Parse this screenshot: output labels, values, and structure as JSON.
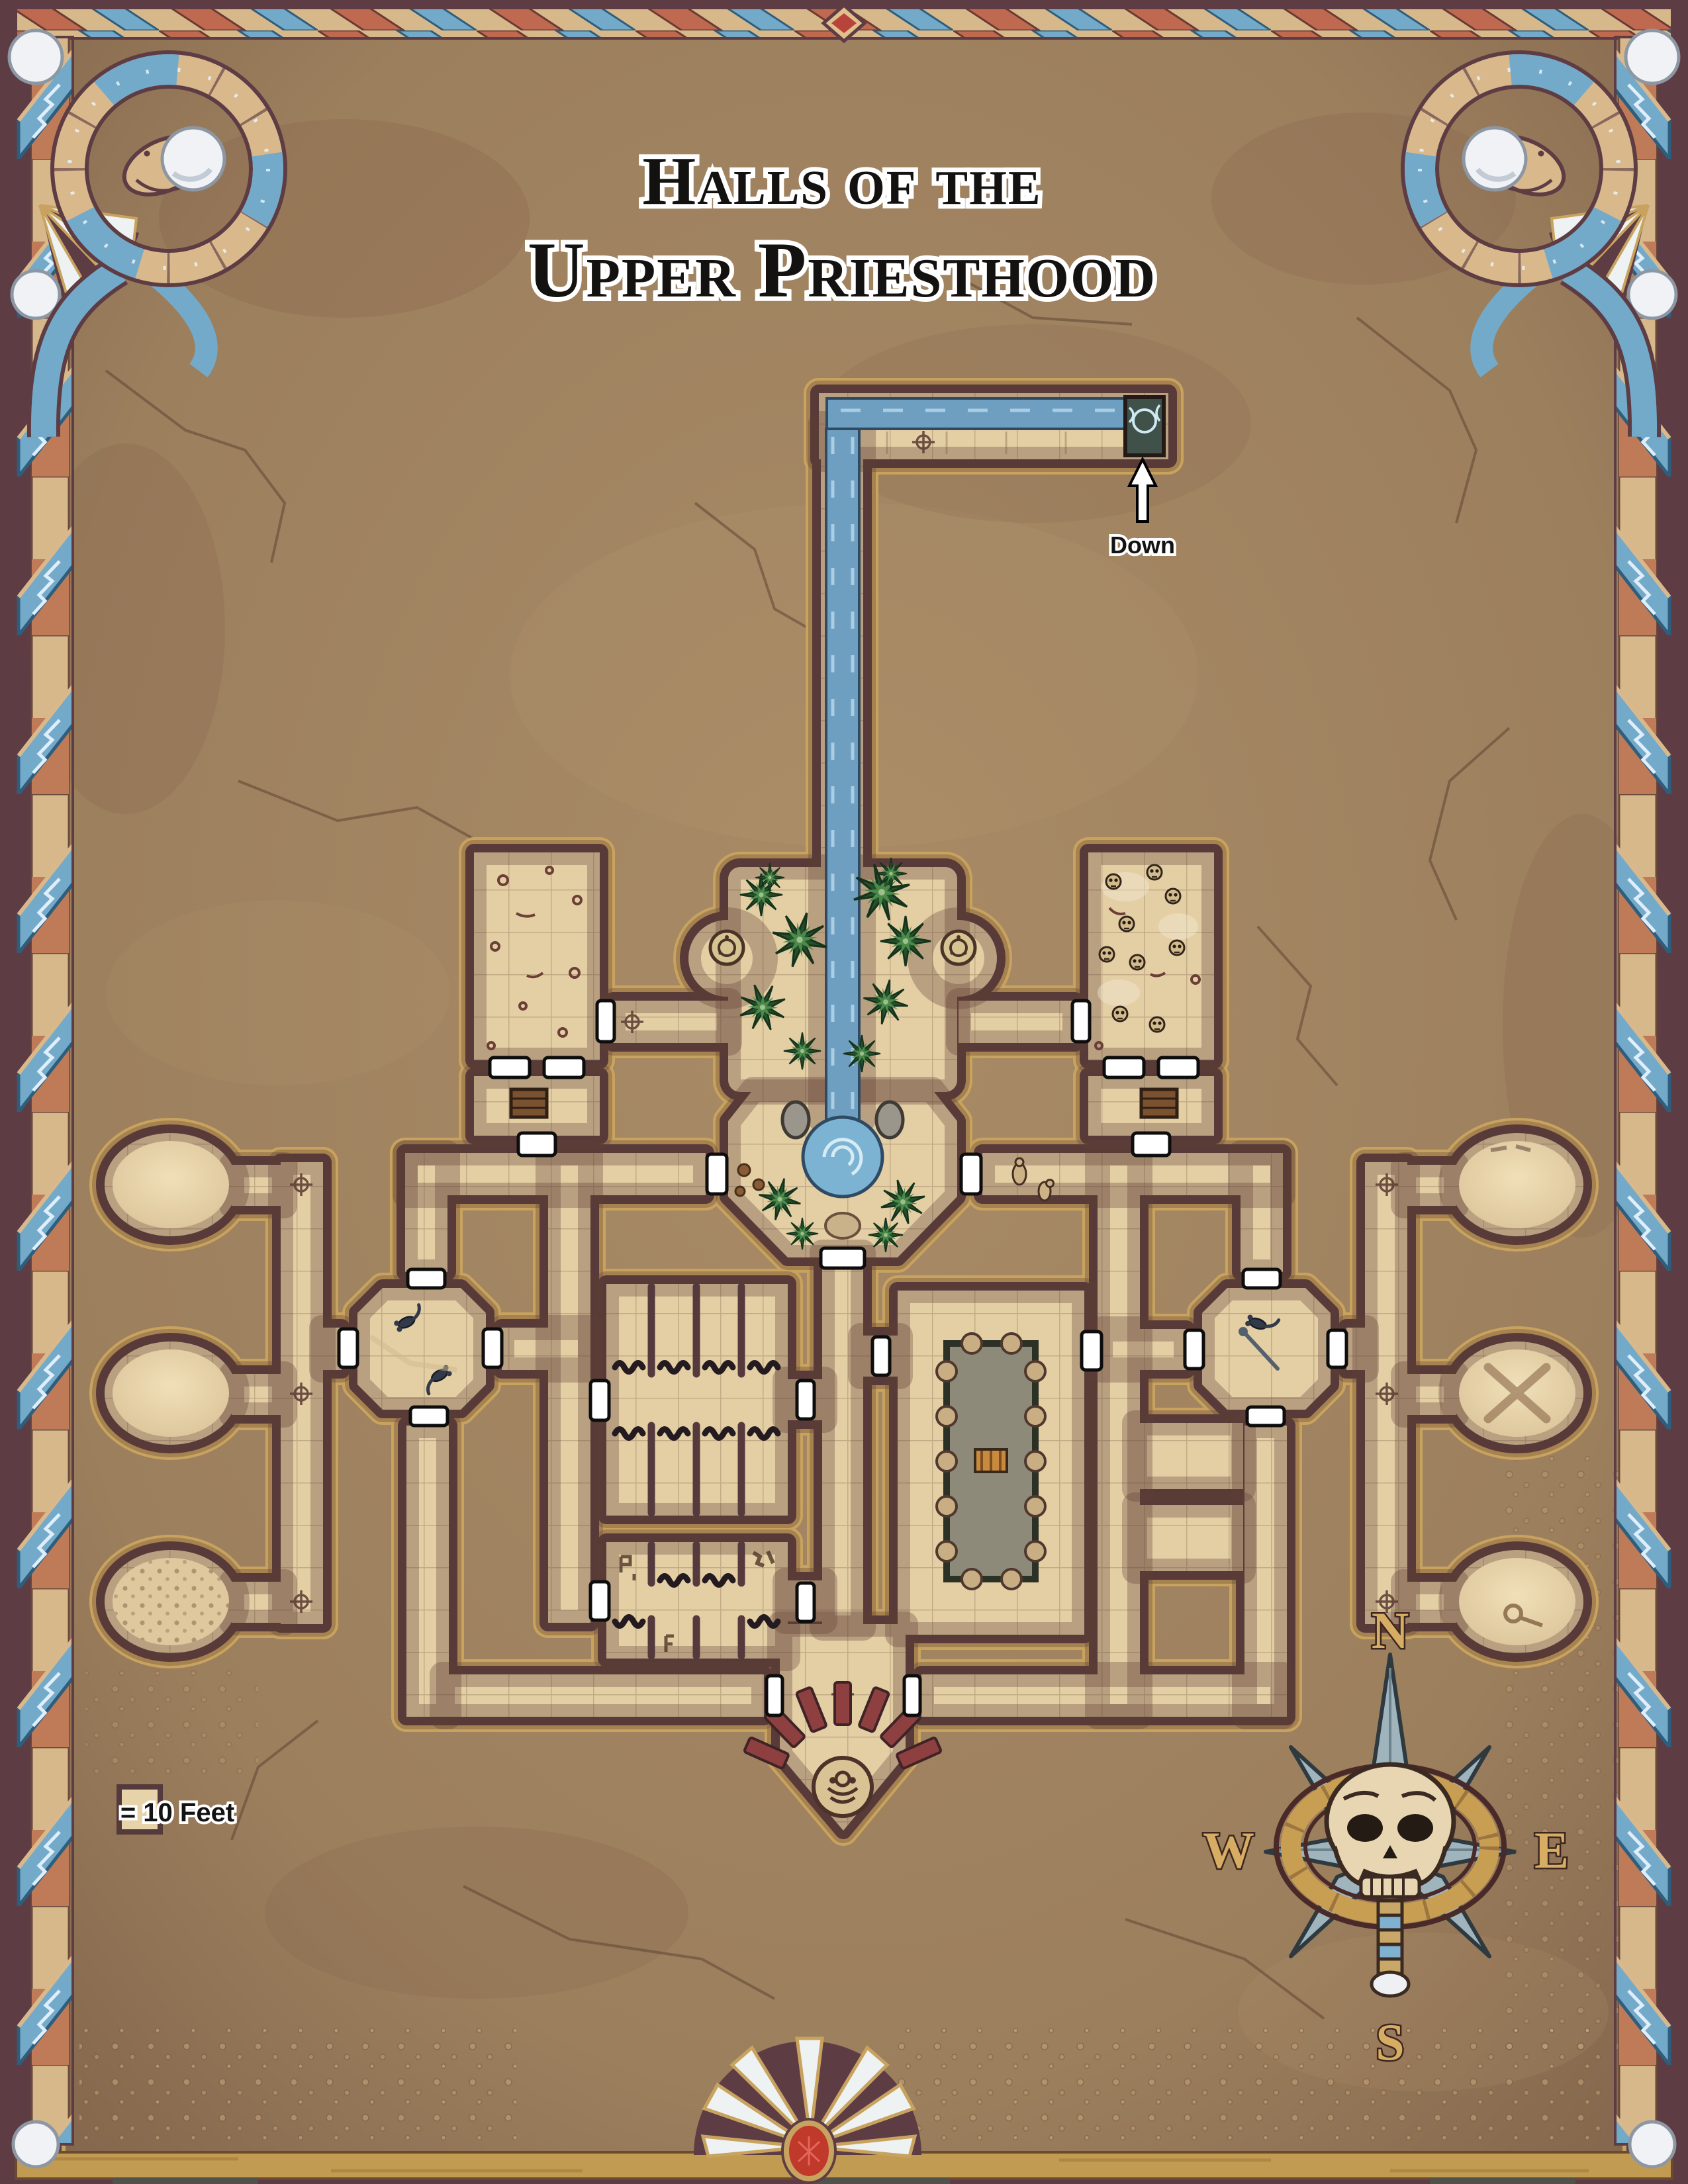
{
  "title": {
    "line1": "Halls of the",
    "line2": "Upper Priesthood"
  },
  "stream": {
    "down_label": "Down"
  },
  "legend": {
    "square_label": "= 10 Feet"
  },
  "compass": {
    "north": "N",
    "east": "E",
    "south": "S",
    "west": "W"
  },
  "map": {
    "name": "Halls of the Upper Priesthood dungeon map",
    "features": [
      "water-stream",
      "waterfall-drain-down",
      "central-garden",
      "garden-whirlpool",
      "nw-store-room",
      "nw-chest-room",
      "ne-skull-room",
      "ne-chest-room",
      "west-rotunda-top",
      "west-rotunda-middle",
      "west-rotunda-speckled",
      "east-rotunda-top",
      "east-rotunda-crossed-staves",
      "east-rotunda-bottom",
      "west-octagon-hall",
      "east-octagon-hall",
      "west-dormitory-upper",
      "west-dormitory-lower",
      "ritual-pool-hall",
      "south-shrine",
      "skull-compass-rose",
      "scale-legend"
    ],
    "colors": {
      "earth": "#9c7f5d",
      "floor": "#e4cfa5",
      "wall": "#543a3c",
      "wall_trim": "#c8a35f",
      "water": "#6f9fc0",
      "plant": "#2f5c33",
      "door": "#ffffff",
      "accent_red": "#b8433a",
      "ribbon_blue": "#74aac9",
      "gold": "#c89e52"
    }
  }
}
